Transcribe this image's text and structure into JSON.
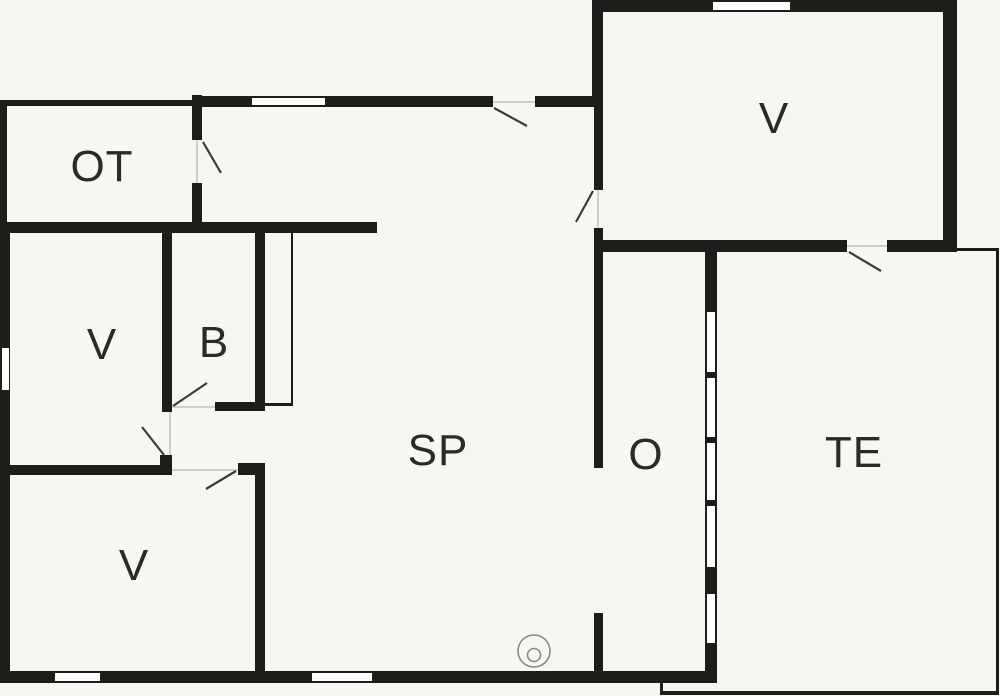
{
  "document": {
    "type": "floor-plan",
    "background_color": "#f7f7f2",
    "wall_color": "#1d1d1b",
    "door_swing_color": "#3a3a38",
    "opening_line_color": "#cfcfc9",
    "fixture_color": "#8a8a85",
    "label_color": "#2a2a28"
  },
  "rooms": {
    "ot": {
      "label": "OT"
    },
    "v_mid_left": {
      "label": "V"
    },
    "b": {
      "label": "B"
    },
    "v_bottom_left": {
      "label": "V"
    },
    "sp": {
      "label": "SP"
    },
    "v_top_right": {
      "label": "V"
    },
    "o": {
      "label": "O"
    },
    "te": {
      "label": "TE"
    }
  },
  "symbols": {
    "stove": "round-stove-symbol"
  }
}
